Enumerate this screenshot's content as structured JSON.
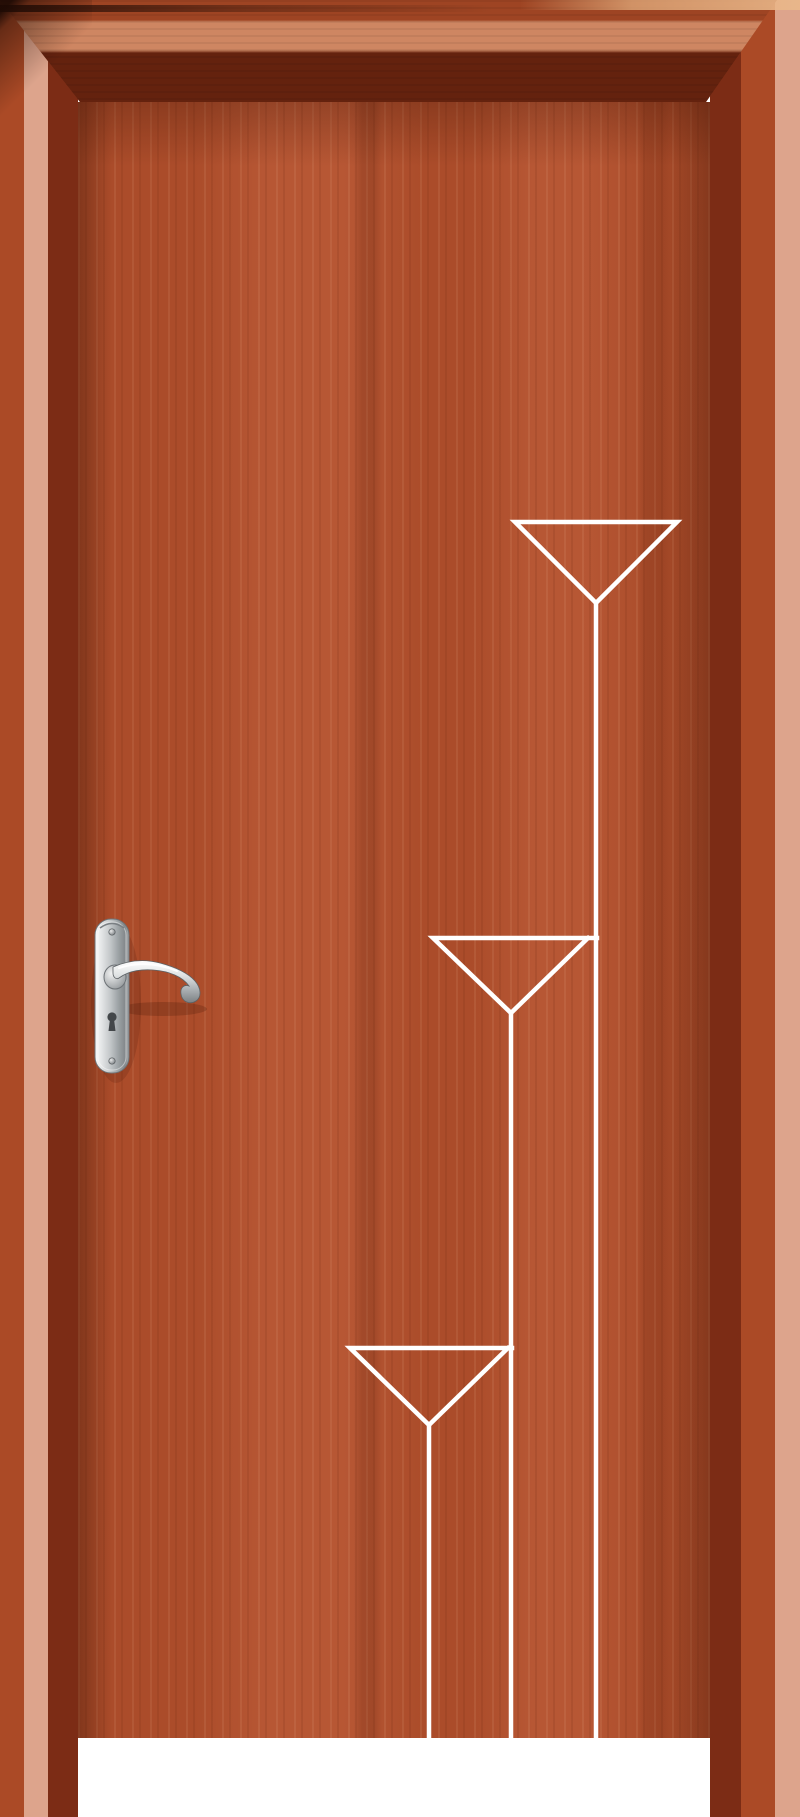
{
  "scene": {
    "type": "product-photo",
    "subject": "Interior wooden door in red-brown veneer with matching frame, chrome lever handle on backplate, and white inlaid decoration of three cascading triangles with vertical lines",
    "background": "#ffffff"
  },
  "palette": {
    "door-leaf": "#b4502c",
    "frame-face": "#ab4a26",
    "frame-highlight": "#dda48c",
    "frame-reveal": "#7c2c15",
    "edge-dark": "#1e0a04",
    "top-bevel-light": "#ca9470",
    "inlay": "#ffffff",
    "floor": "#ffffff",
    "chrome-light": "#f6f7f7",
    "chrome-mid": "#c0c4c6",
    "chrome-dark": "#7c8184"
  },
  "decoration": {
    "stroke_width": 4.5,
    "shapes": [
      {
        "name": "triangle-top",
        "d": "M515,522 L677,522 L596,603 Z"
      },
      {
        "name": "line-top",
        "d": "M596,603 L596,1738"
      },
      {
        "name": "triangle-middle",
        "d": "M597,938 L433,938 L511,1013 L588,938"
      },
      {
        "name": "line-middle",
        "d": "M511,1013 L511,1738"
      },
      {
        "name": "triangle-bottom",
        "d": "M512,1348 L350,1348 L429,1425 L508,1348"
      },
      {
        "name": "line-bottom",
        "d": "M429,1425 L429,1738"
      }
    ]
  },
  "handle": {
    "finish": "polished chrome",
    "style": "scroll lever on rounded backplate",
    "side": "left",
    "parts": [
      "backplate",
      "lever",
      "boss",
      "keyhole",
      "top-screw",
      "bottom-screw"
    ]
  }
}
